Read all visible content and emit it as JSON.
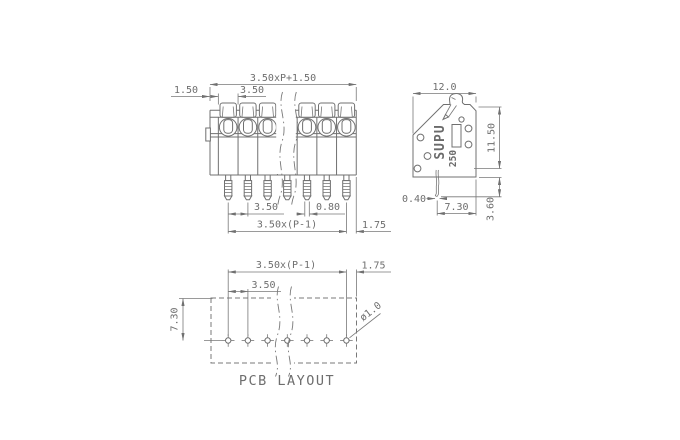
{
  "meta": {
    "drawing_type": "terminal block technical drawing",
    "background": "#ffffff",
    "line_color": "#707070",
    "text_color": "#6e6e6e"
  },
  "front_view": {
    "positions_shown": 7,
    "dims": {
      "total_width": "3.50xP+1.50",
      "edge_margin": "1.50",
      "pitch_top": "3.50",
      "pitch_bottom": "3.50",
      "pin_width": "0.80",
      "pin_span": "3.50x(P-1)",
      "last_pin_to_edge": "1.75"
    }
  },
  "side_view": {
    "brand": "SUPU",
    "series": "250",
    "dims": {
      "depth": "12.0",
      "height": "11.50",
      "pin_thickness": "0.40",
      "pin_to_back": "7.30",
      "pin_length": "3.60"
    }
  },
  "pcb_layout": {
    "title": "PCB LAYOUT",
    "holes_shown": 7,
    "dims": {
      "hole_span": "3.50x(P-1)",
      "edge_margin": "1.75",
      "pitch": "3.50",
      "row_offset": "7.30",
      "hole_diameter": "ø1.0"
    }
  }
}
